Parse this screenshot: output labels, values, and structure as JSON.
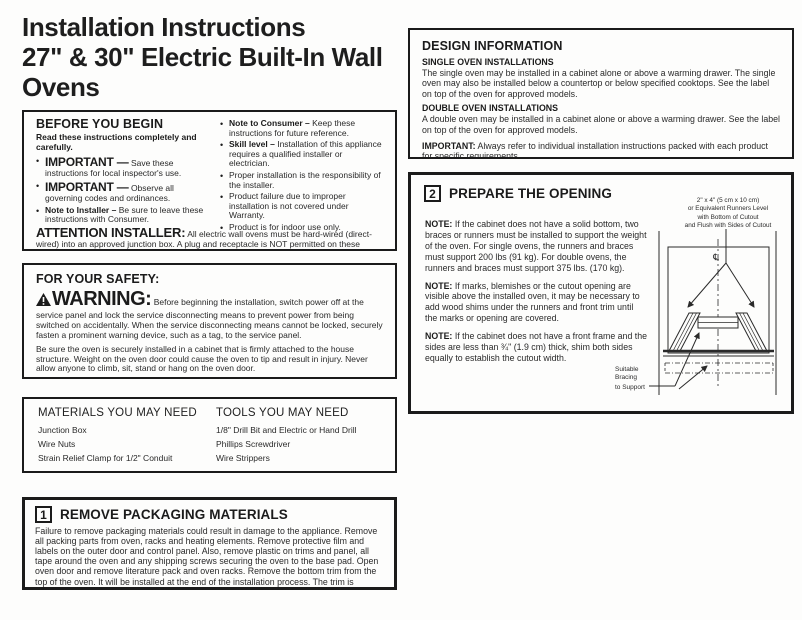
{
  "colors": {
    "text": "#1e1e1e",
    "border": "#1b1b1b",
    "background": "#fdfdfc"
  },
  "page": {
    "title_line1": "Installation Instructions",
    "title_line2": "27\" & 30\" Electric Built-In Wall Ovens",
    "questions_label": "Questions?",
    "questions_rest": " Call 1.800.GE.CARES (1.800.432.2737) or visit www.GEAppliances.com",
    "canada_line": "In Canada, call 1.800.561.3344 or visit www.GEAppliances.ca"
  },
  "before_you_begin": {
    "heading": "BEFORE YOU BEGIN",
    "intro": "Read these instructions completely and carefully.",
    "left_bullets": [
      {
        "lead": "IMPORTANT —",
        "text": " Save these instructions for local inspector's use."
      },
      {
        "lead": "IMPORTANT —",
        "text": " Observe all governing codes and ordinances."
      },
      {
        "lead": "Note to Installer –",
        "text": " Be sure to leave these instructions with Consumer."
      }
    ],
    "right_bullets": [
      {
        "lead": "Note to Consumer –",
        "text": " Keep these instructions for future reference."
      },
      {
        "lead": "Skill level –",
        "text": " Installation of this appliance requires a qualified installer or electrician."
      },
      {
        "lead": "",
        "text": "Proper installation is the responsibility of the installer."
      },
      {
        "lead": "",
        "text": "Product failure due to improper installation is not covered under Warranty."
      },
      {
        "lead": "",
        "text": "Product is for indoor use only."
      }
    ],
    "attention_lead": "ATTENTION INSTALLER:",
    "attention_text": " All electric wall ovens must be hard-wired (direct-wired) into an approved junction box. A plug and receptacle is NOT permitted on these products."
  },
  "for_your_safety": {
    "heading": "FOR YOUR SAFETY:",
    "warning_word": "WARNING:",
    "warning_text": " Before beginning the installation, switch power off at the service panel and lock the service disconnecting means to prevent power from being switched on accidentally. When the service disconnecting means cannot be locked, securely fasten a prominent warning device, such as a tag, to the service panel.",
    "para2": "Be sure the oven is securely installed in a cabinet that is firmly attached to the house structure. Weight on the oven door could cause the oven to tip and result in injury. Never allow anyone to climb, sit, stand or hang on the oven door.",
    "para3": "Make sure the wall coverings, counters and cabinets around the oven can withstand the heat (up to 200°F [93.3°C]) generated by the oven."
  },
  "materials_tools": {
    "materials_heading": "MATERIALS YOU MAY NEED",
    "materials_items": [
      "Junction Box",
      "Wire Nuts",
      "Strain Relief Clamp for 1/2\" Conduit"
    ],
    "tools_heading": "TOOLS YOU MAY NEED",
    "tools_items": [
      "1/8\" Drill Bit and Electric or Hand Drill",
      "Phillips Screwdriver",
      "Wire Strippers"
    ]
  },
  "step1": {
    "number": "1",
    "heading": "REMOVE PACKAGING MATERIALS",
    "body": "Failure to remove packaging materials could result in damage to the appliance. Remove all packing parts from oven, racks and heating elements. Remove protective film and labels on the outer door and control panel. Also, remove plastic on trims and panel, all tape around the oven and any shipping screws securing the oven to the base pad. Open oven door and remove literature pack and oven racks. Remove the bottom trim from the top of the oven. It will be installed at the end of the installation process. The trim is wrapped separately and taped to the top of the unit. Remove pedestal rails from seperate box and set aside (30\" Double Wall Ovens Only)."
  },
  "design_information": {
    "heading": "DESIGN INFORMATION",
    "single_heading": "SINGLE OVEN INSTALLATIONS",
    "single_body": "The single oven may be installed in a cabinet alone or above a warming drawer. The single oven may also be installed below a countertop or below specified cooktops. See the label on top of the oven for approved models.",
    "double_heading": "DOUBLE OVEN INSTALLATIONS",
    "double_body": "A double oven may be installed in a cabinet alone or above a warming drawer. See the label on top of the oven for approved models.",
    "important_lead": "IMPORTANT:",
    "important_text": " Always refer to individual installation instructions packed with each product for specific requirements."
  },
  "step2": {
    "number": "2",
    "heading": "PREPARE THE OPENING",
    "notes": [
      {
        "lead": "NOTE:",
        "text": " If the cabinet does not have a solid bottom, two braces or runners must be installed to support the weight of the oven. For single ovens, the runners and braces must support 200 lbs (91 kg). For double ovens, the runners and braces must support 375 lbs. (170 kg)."
      },
      {
        "lead": "NOTE:",
        "text": " If marks, blemishes or the cutout opening are visible above the installed oven, it may be necessary to add wood shims under the runners and front trim until the marks or opening are covered."
      },
      {
        "lead": "NOTE:",
        "text": " If the cabinet does not have a front frame and the sides are less than ¾\" (1.9 cm) thick, shim both sides equally to establish the cutout width."
      }
    ],
    "diagram": {
      "runner_label": "2\" x 4\" (5 cm x 10 cm)\nor Equivalent Runners Level\nwith Bottom of Cutout\nand Flush with Sides of Cutout",
      "centerline_symbol": "℄",
      "bracing_lines": [
        "Suitable",
        "Bracing",
        "to Support"
      ]
    }
  }
}
